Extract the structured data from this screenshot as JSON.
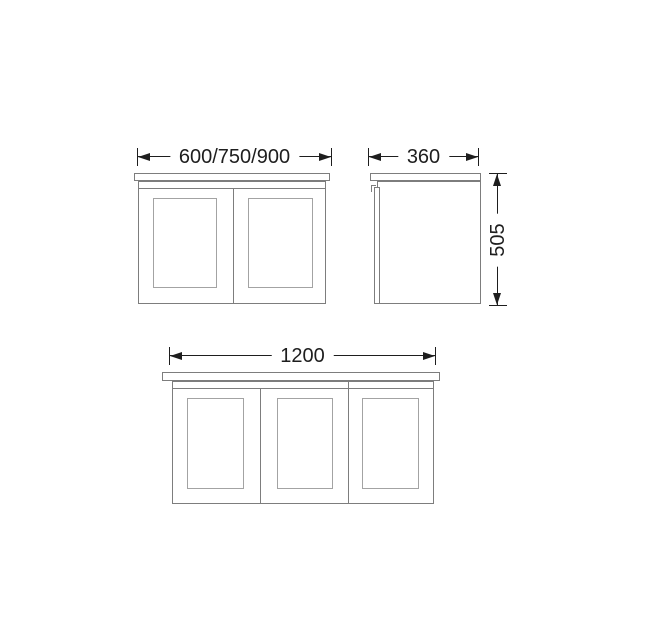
{
  "drawing": {
    "kind": "technical-dimension-drawing",
    "subject": "wall-hung cabinet / vanity unit, three orthographic views",
    "labels": {
      "front_small_width": "600/750/900",
      "side_depth": "360",
      "side_height": "505",
      "front_large_width": "1200"
    },
    "views": [
      {
        "id": "front-view-two-door",
        "doors": 2,
        "width_mm": "600/750/900"
      },
      {
        "id": "side-view",
        "depth_mm": "360",
        "height_mm": "505"
      },
      {
        "id": "front-view-three-door",
        "doors": 3,
        "width_mm": "1200"
      }
    ],
    "colors": {
      "background": "#ffffff",
      "dimension_line": "#1e1e1e",
      "cabinet_outline": "#7d7d7d",
      "panel_outline": "#a3a3a3"
    }
  }
}
